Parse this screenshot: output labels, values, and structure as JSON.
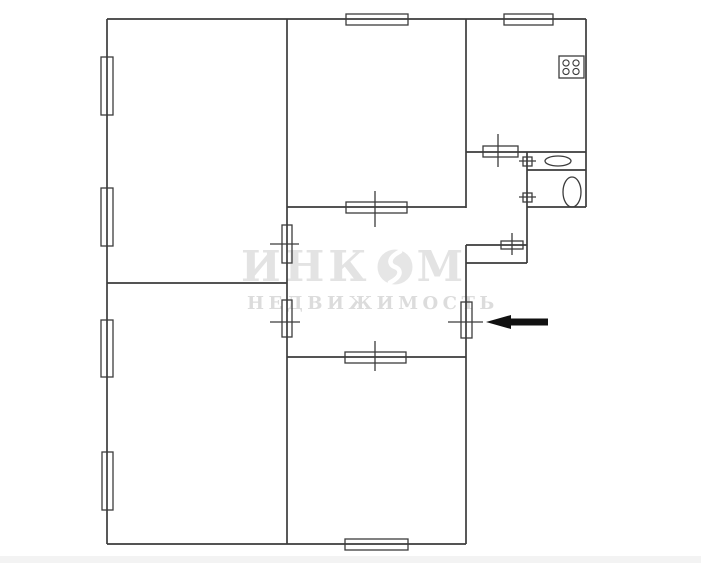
{
  "canvas": {
    "width": 701,
    "height": 563,
    "background_color": "#ffffff"
  },
  "watermark": {
    "brand_prefix": "ИНК",
    "brand_suffix": "М",
    "subtitle": "НЕДВИЖИМОСТЬ",
    "brand_color": "#e3e3e3",
    "subtitle_color": "#dcdcdc",
    "logo_circle_color": "#e6e6e6"
  },
  "plan": {
    "stroke_color": "#3c3c3c",
    "wall_width": 1.7,
    "thin_width": 1.3,
    "walls": [
      [
        107,
        19,
        586,
        19
      ],
      [
        107,
        19,
        107,
        544
      ],
      [
        107,
        544,
        466,
        544
      ],
      [
        466,
        245,
        466,
        544
      ],
      [
        466,
        263,
        527,
        263
      ],
      [
        527,
        152,
        527,
        263
      ],
      [
        527,
        207,
        586,
        207
      ],
      [
        586,
        19,
        586,
        207
      ],
      [
        287,
        19,
        287,
        544
      ],
      [
        107,
        283,
        287,
        283
      ],
      [
        287,
        207,
        466,
        207
      ],
      [
        287,
        357,
        466,
        357
      ],
      [
        466,
        19,
        466,
        208
      ],
      [
        466,
        152,
        586,
        152
      ],
      [
        527,
        170,
        586,
        170
      ],
      [
        466,
        245,
        527,
        245
      ]
    ],
    "windows": [
      {
        "x": 101,
        "y": 57,
        "w": 12,
        "h": 58,
        "name": "window-left-1"
      },
      {
        "x": 101,
        "y": 188,
        "w": 12,
        "h": 58,
        "name": "window-left-2"
      },
      {
        "x": 101,
        "y": 320,
        "w": 12,
        "h": 57,
        "name": "window-left-3"
      },
      {
        "x": 102,
        "y": 452,
        "w": 11,
        "h": 58,
        "name": "window-left-4"
      },
      {
        "x": 346,
        "y": 14,
        "w": 62,
        "h": 11,
        "name": "window-top-1"
      },
      {
        "x": 504,
        "y": 14,
        "w": 49,
        "h": 11,
        "name": "window-top-kitchen"
      },
      {
        "x": 345,
        "y": 539,
        "w": 63,
        "h": 11,
        "name": "window-bottom-1"
      }
    ],
    "doors": [
      {
        "x": 282,
        "y": 225,
        "w": 10,
        "h": 38,
        "tick": [
          270,
          244,
          299,
          244
        ],
        "name": "door-room-top-left"
      },
      {
        "x": 282,
        "y": 300,
        "w": 10,
        "h": 37,
        "tick": [
          270,
          322,
          300,
          322
        ],
        "name": "door-room-bottom-left"
      },
      {
        "x": 346,
        "y": 202,
        "w": 61,
        "h": 11,
        "tick": [
          375,
          191,
          375,
          227
        ],
        "name": "door-room-top-middle"
      },
      {
        "x": 345,
        "y": 352,
        "w": 61,
        "h": 11,
        "tick": [
          375,
          341,
          375,
          371
        ],
        "name": "door-room-bottom-middle"
      },
      {
        "x": 483,
        "y": 146,
        "w": 35,
        "h": 11,
        "tick": [
          498,
          134,
          498,
          167
        ],
        "name": "door-kitchen"
      },
      {
        "x": 501,
        "y": 241,
        "w": 22,
        "h": 8,
        "tick": [
          512,
          233,
          512,
          255
        ],
        "name": "door-closet"
      },
      {
        "x": 523,
        "y": 157,
        "w": 9,
        "h": 9,
        "tick": [
          519,
          161,
          536,
          161
        ],
        "name": "door-bathroom"
      },
      {
        "x": 523,
        "y": 193,
        "w": 9,
        "h": 9,
        "tick": [
          519,
          197,
          536,
          197
        ],
        "name": "door-wc"
      },
      {
        "x": 461,
        "y": 302,
        "w": 11,
        "h": 36,
        "tick": [
          448,
          322,
          483,
          322
        ],
        "name": "door-entrance"
      }
    ],
    "fixtures": {
      "stove": {
        "x": 559,
        "y": 56,
        "w": 25,
        "h": 22,
        "burner_r": 3.1,
        "burners": [
          [
            566,
            63
          ],
          [
            576,
            63
          ],
          [
            566,
            71.5
          ],
          [
            576,
            71.5
          ]
        ]
      },
      "sink": {
        "cx": 558,
        "cy": 161,
        "rx": 13,
        "ry": 5
      },
      "toilet": {
        "cx": 572,
        "cy": 192,
        "rx": 9,
        "ry": 15
      }
    },
    "entrance_arrow": {
      "color": "#111111",
      "points": "486,322 511,315 511,318.5 548,318.5 548,325.5 511,325.5 511,329"
    }
  }
}
